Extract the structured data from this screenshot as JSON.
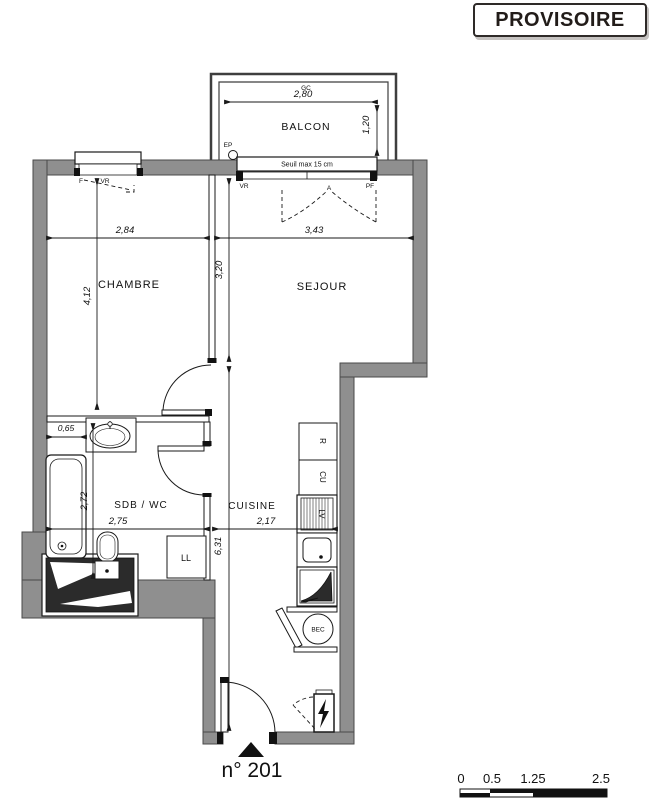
{
  "stamp": {
    "label": "PROVISOIRE"
  },
  "title": {
    "unit": "n° 201"
  },
  "rooms": {
    "balcon": "BALCON",
    "chambre": "CHAMBRE",
    "sejour": "SEJOUR",
    "sdb": "SDB / WC",
    "cuisine": "CUISINE"
  },
  "dims": {
    "balcon_w": "2,80",
    "balcon_d": "1,20",
    "chambre_w": "2,84",
    "chambre_h": "4,12",
    "sejour_w": "3,43",
    "sejour_h": "3,20",
    "corridor_h": "6,31",
    "sdb_w": "2,75",
    "sdb_h": "2,72",
    "tub_w": "0,65",
    "cuisine_w": "2,17"
  },
  "labels": {
    "seuil": "Seuil max 15 cm",
    "gc": "GC",
    "ep": "EP",
    "f": "F",
    "vr_chambre": "VR",
    "vr_sejour": "VR",
    "pf": "PF",
    "a": "A",
    "r": "R",
    "cu": "CU",
    "lv": "LV",
    "ll": "LL",
    "bec": "BEC"
  },
  "scale_bar": {
    "ticks": [
      "0",
      "0.5",
      "1.25",
      "2.5"
    ]
  },
  "colors": {
    "wall": "#8f8f8f",
    "line": "#1a1a1a",
    "shaft": "#2b2b2b"
  }
}
